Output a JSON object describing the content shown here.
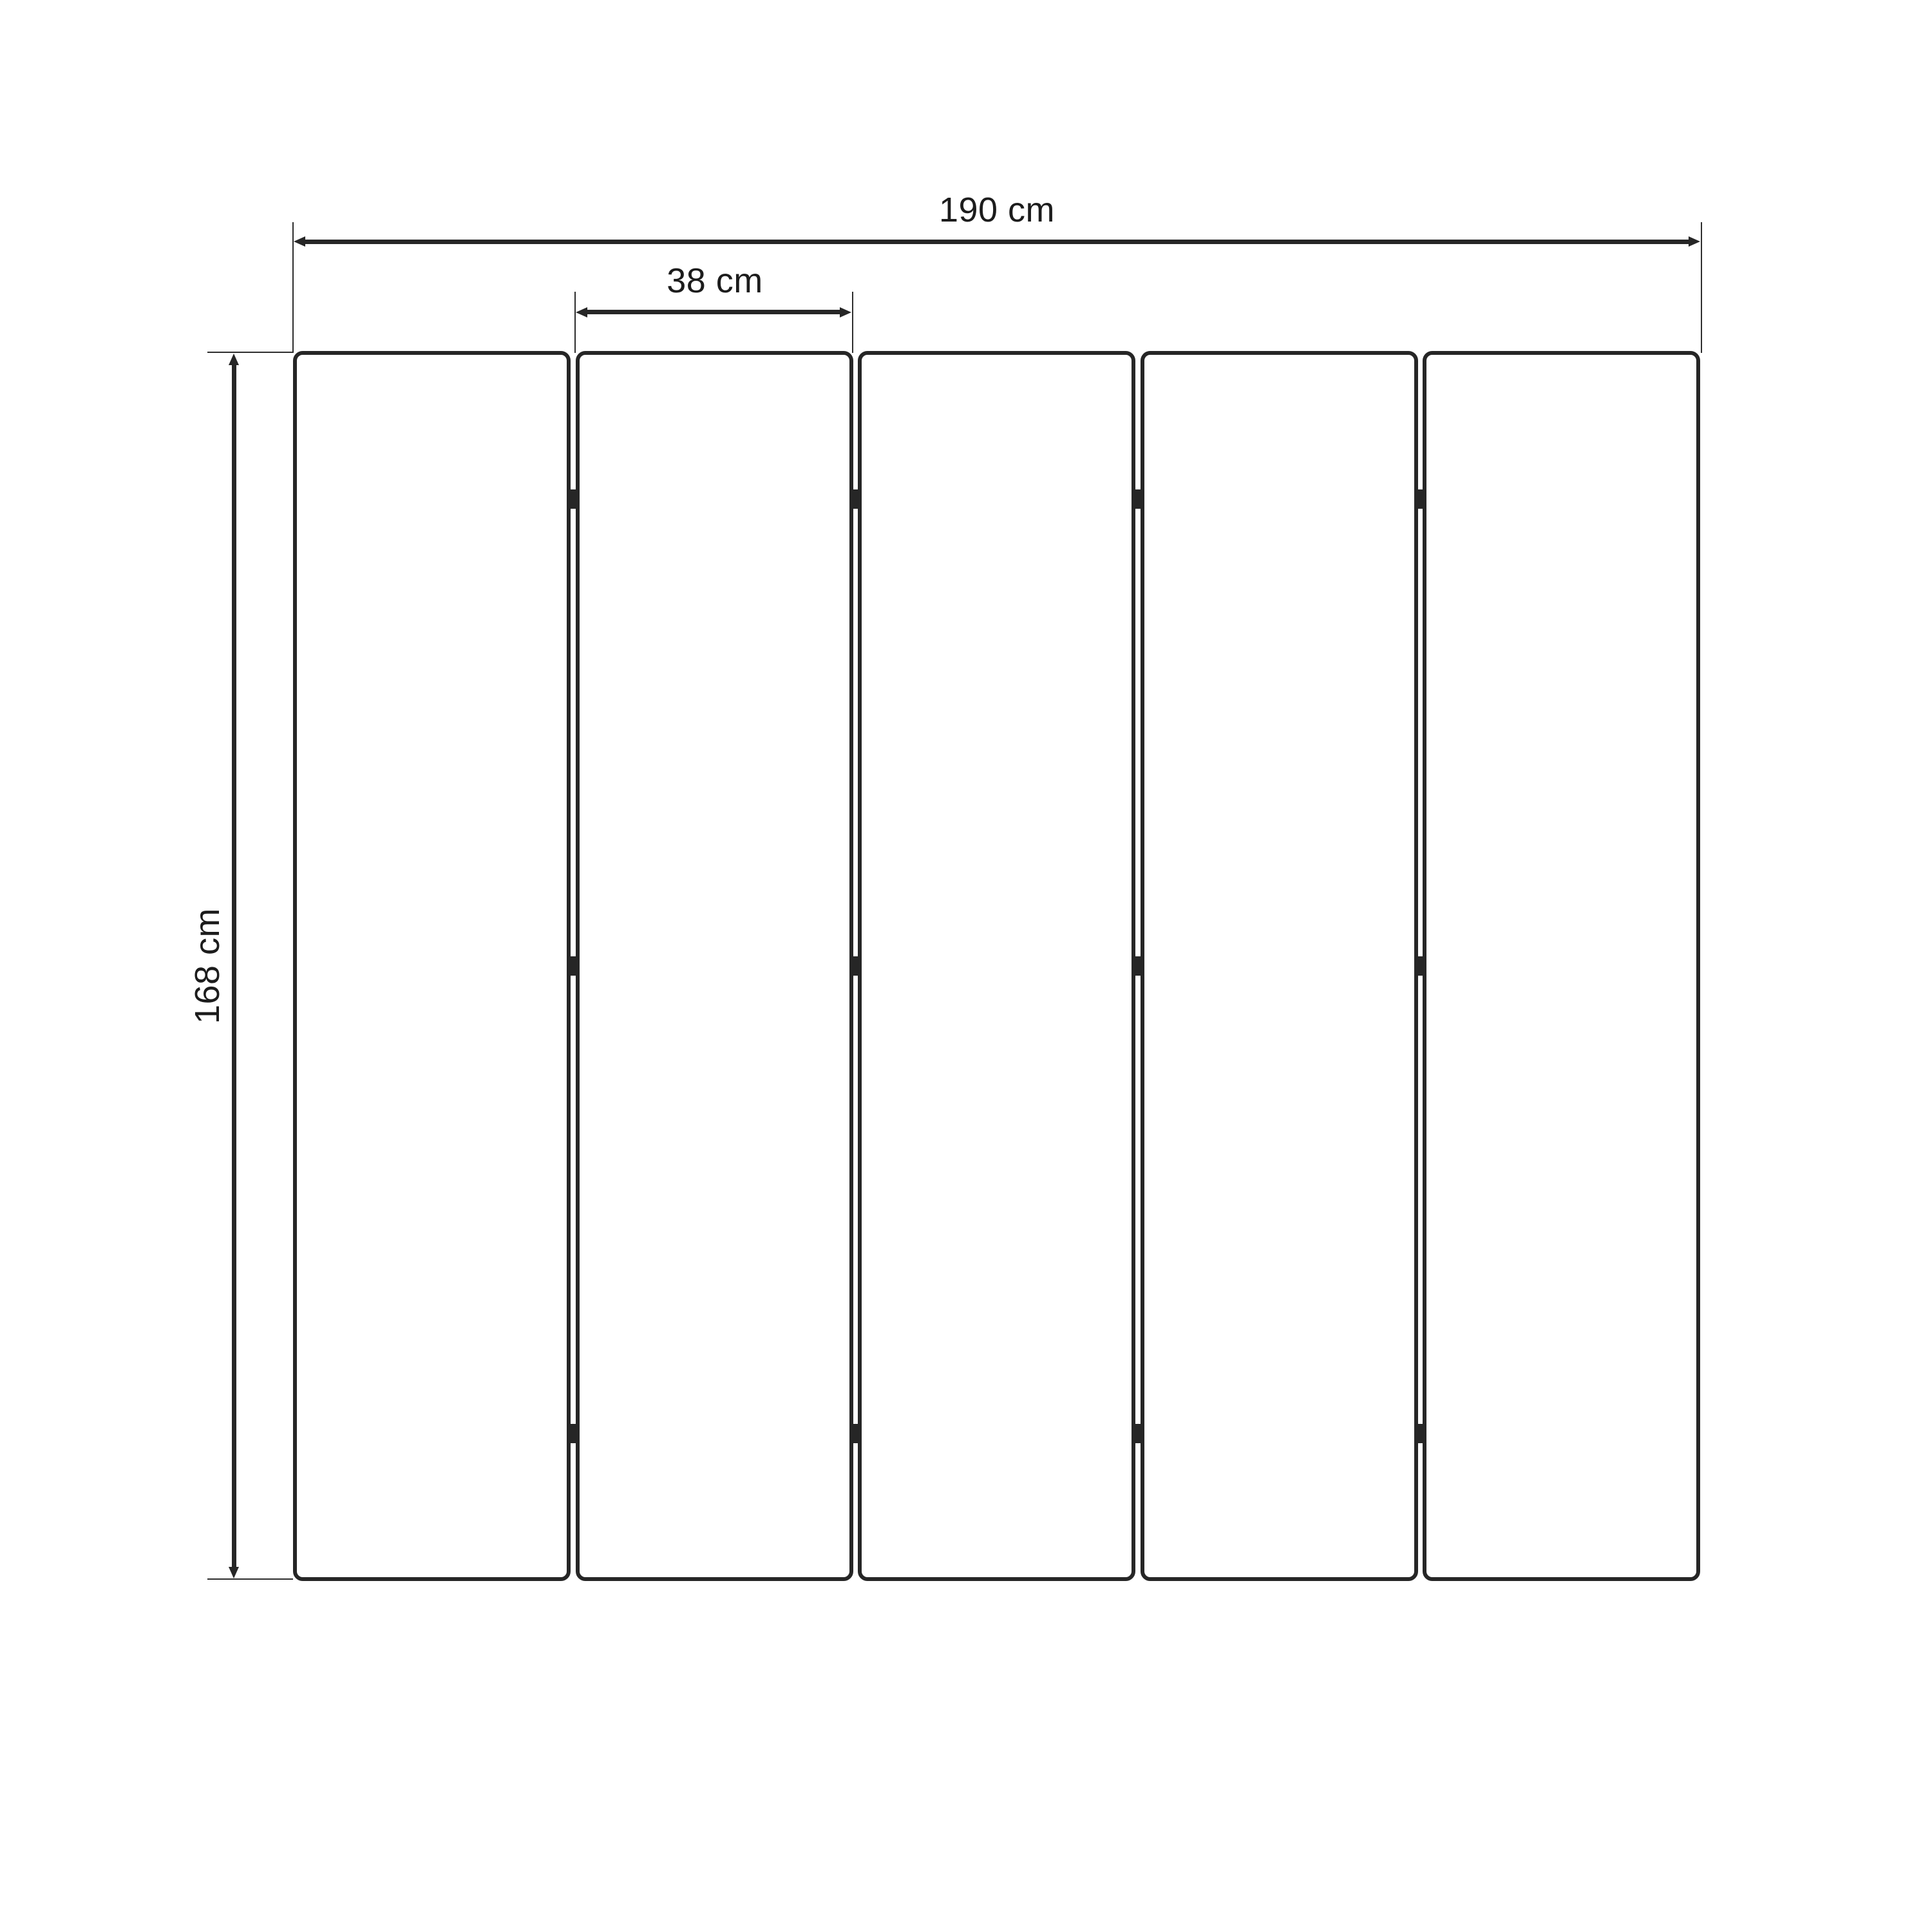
{
  "diagram": {
    "type": "folding-screen-dimension-drawing",
    "background_color": "#ffffff",
    "line_color": "#262626",
    "panel_count": 5,
    "hinge_rows_per_junction": 3,
    "labels": {
      "total_width": "190 cm",
      "panel_width": "38 cm",
      "height": "168 cm"
    }
  }
}
